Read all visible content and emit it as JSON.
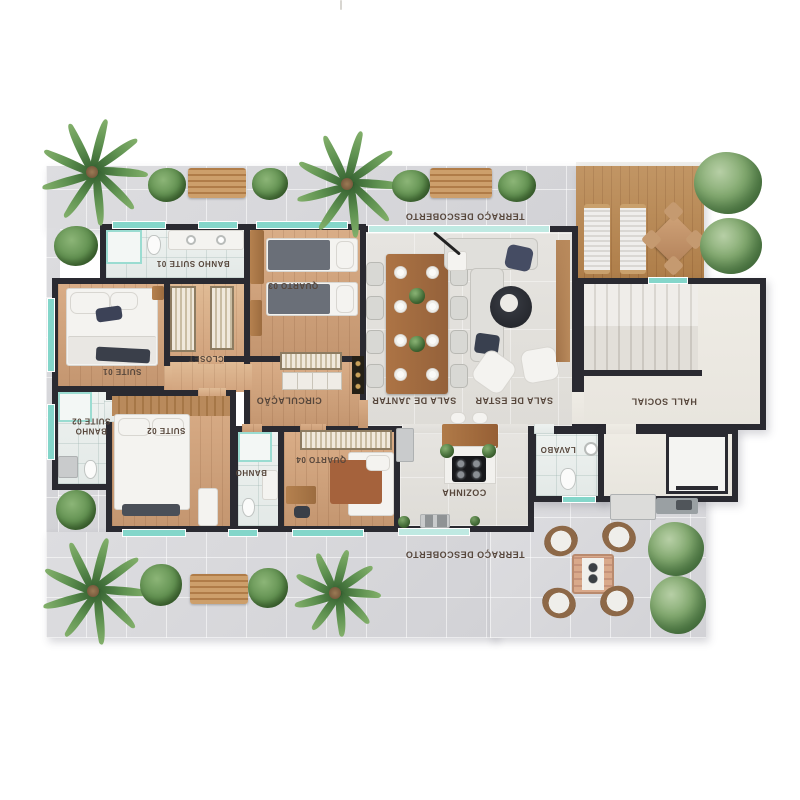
{
  "meta": {
    "type": "residential floor plan, top-down 3D render",
    "language": "pt-BR"
  },
  "colors": {
    "wall": "#2a2a31",
    "glass": "#84d6ca",
    "marble": "#d8d8db",
    "wood_floor": "#cf9f78",
    "deck_wood": "#b9874f",
    "living_floor": "#e3e1dd",
    "hall_floor": "#edeae3",
    "bath_tile": "#eaefec",
    "label_text": "#57473c",
    "plant_green": "#5d8f53",
    "furniture_white": "#f4f3f0",
    "accent_navy": "#3c4257"
  },
  "labels": {
    "terraco_top": "TERRAÇO DESCOBERTO",
    "banho_suite_01": "BANHO SUITE 01",
    "quarto_03": "QUARTO 03",
    "suite_01": "SUITE 01",
    "closet": "CLOSET",
    "circulacao": "CIRCULAÇÃO",
    "sala_de_jantar": "SALA DE JANTAR",
    "sala_de_estar": "SALA DE ESTAR",
    "hall_social": "HALL SOCIAL",
    "banho_suite_02_l1": "BANHO",
    "banho_suite_02_l2": "SUITE 02",
    "suite_02": "SUITE 02",
    "banho": "BANHO",
    "quarto_04": "QUARTO 04",
    "cozinha": "COZINHA",
    "lavabo": "LAVABO",
    "terraco_bottom": "TERRAÇO DESCOBERTO"
  }
}
